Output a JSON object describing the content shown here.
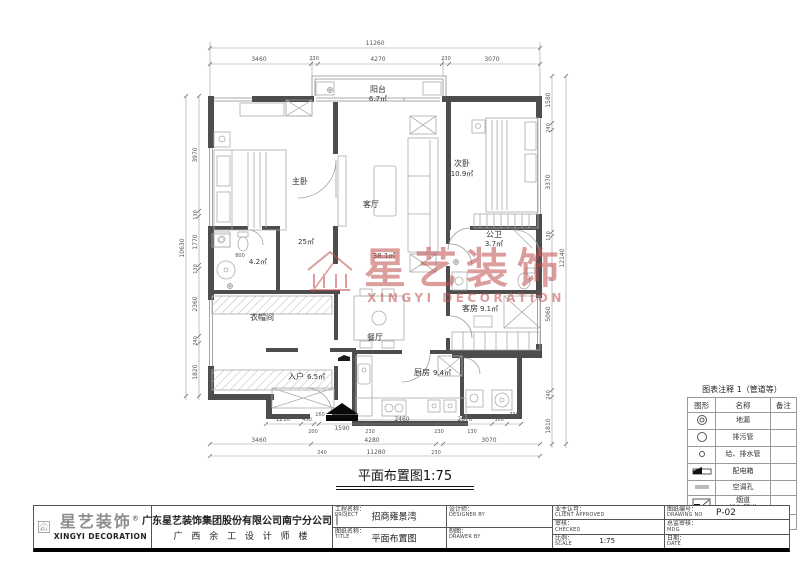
{
  "plan": {
    "title": "平面布置图1:75",
    "rooms": {
      "balcony_name": "阳台",
      "balcony_area": "6.7㎡",
      "master_name": "主卧",
      "master_area": "25㎡",
      "living_name": "客厅",
      "living_area": "38.1㎡",
      "second_name": "次卧",
      "second_area": "10.9㎡",
      "master_bath_area": "4.2㎡",
      "cloakroom_name": "衣帽间",
      "entry_name": "入户",
      "entry_area": "6.5㎡",
      "dining_name": "餐厅",
      "kitchen_name": "厨房",
      "kitchen_area": "9.4㎡",
      "guest_name": "客房",
      "guest_area": "9.1㎡",
      "public_bath_name": "公卫",
      "public_bath_area": "3.7㎡"
    },
    "dims": {
      "top_total": "11260",
      "top": [
        "3460",
        "230",
        "4270",
        "230",
        "3070"
      ],
      "left_total": "10630",
      "left": [
        "3970",
        "130",
        "1770",
        "130",
        "2360",
        "240",
        "1820"
      ],
      "right_total": "12140",
      "right": [
        "1580",
        "240",
        "3370",
        "130",
        "5060",
        "240",
        "1810"
      ],
      "bottom1": [
        "1210",
        "430",
        "160",
        "1590",
        "2460",
        "2070",
        "500",
        "730"
      ],
      "bottom2": [
        "200",
        "230",
        "230",
        "130"
      ],
      "bottom3": [
        "3460",
        "4280",
        "3070"
      ],
      "bottom4": [
        "240",
        "11280",
        "230"
      ],
      "shower": "800"
    }
  },
  "watermark": {
    "brand_cn": "星艺装饰",
    "brand_en": "XINGYI DECORATION",
    "color": "#c0504e"
  },
  "legend": {
    "title": "图表注释 1（管道等）",
    "headers": [
      "图形",
      "名称",
      "备注"
    ],
    "rows": [
      {
        "icon": "floor-drain-icon",
        "name": "地漏",
        "note": ""
      },
      {
        "icon": "sewage-pipe-icon",
        "name": "排污管",
        "note": ""
      },
      {
        "icon": "supply-drain-pipe-icon",
        "name": "给、排水管",
        "note": ""
      },
      {
        "icon": "distribution-box-icon",
        "name": "配电箱",
        "note": ""
      },
      {
        "icon": "ac-hole-icon",
        "name": "空调孔",
        "note": ""
      },
      {
        "icon": "flue-exhaust-icon",
        "name": "烟道\n排气管道",
        "note": ""
      },
      {
        "icon": "multimedia-box-icon",
        "name": "多媒体布线箱",
        "note": ""
      }
    ]
  },
  "titleblock": {
    "project_cn": "工程名称：",
    "project_en": "PROJECT",
    "project_value": "招商雍景湾",
    "sheet_cn": "图纸名称：",
    "sheet_en": "TITLE",
    "sheet_value": "平面布置图",
    "designer_cn": "设计师：",
    "designer_en": "DESIGNER BY",
    "drawer_cn": "制图：",
    "drawer_en": "DRAWER BY",
    "client_cn": "业主认可：",
    "client_en": "CLIENT APPROVED",
    "checked_cn": "审核：",
    "checked_en": "CHECKED",
    "scale_cn": "比例：",
    "scale_en": "SCALE",
    "scale_value": "1:75",
    "drawingno_cn": "图纸编号：",
    "drawingno_en": "DRAWING NO",
    "drawingno_value": "P-02",
    "director_cn": "总监审核：",
    "director_en": "MDG",
    "date_cn": "日期：",
    "date_en": "DATE"
  },
  "footer": {
    "brand_cn": "星艺装饰",
    "brand_reg": "®",
    "brand_en": "XINGYI DECORATION",
    "company_line1": "广东星艺装饰集团股份有限公司南宁分公司｜",
    "company_line2": "广 西 余 工 设 计 师 楼"
  }
}
